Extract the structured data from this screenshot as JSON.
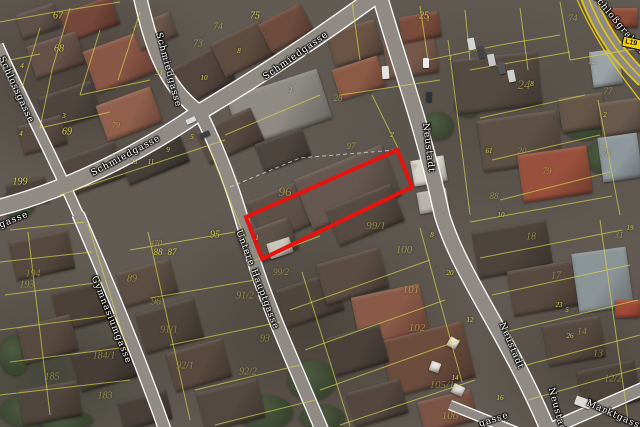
{
  "map": {
    "selected_parcel": {
      "outline_color": "#e8120e",
      "polygon": [
        [
          246,
          217
        ],
        [
          397,
          150
        ],
        [
          412,
          187
        ],
        [
          262,
          259
        ]
      ]
    },
    "route_badge": {
      "label": "L19",
      "bg_color": "#f2d10c"
    },
    "street_labels": [
      {
        "t": "Schmiedgasse",
        "x": 168,
        "y": 70,
        "r": 75
      },
      {
        "t": "Schmiedgasse",
        "x": 296,
        "y": 56,
        "r": -35
      },
      {
        "t": "Schmiedgasse",
        "x": 126,
        "y": 156,
        "r": -28
      },
      {
        "t": "Schlossgasse",
        "x": 16,
        "y": 90,
        "r": 65
      },
      {
        "t": "Gymnasiumgasse",
        "x": 111,
        "y": 320,
        "r": 68
      },
      {
        "t": "Untere Hauptgasse",
        "x": 257,
        "y": 280,
        "r": 69
      },
      {
        "t": "Neustadt",
        "x": 428,
        "y": 148,
        "r": 83
      },
      {
        "t": "Neustadt",
        "x": 511,
        "y": 346,
        "r": 67
      },
      {
        "t": "Neustadt",
        "x": 557,
        "y": 412,
        "r": 75
      },
      {
        "t": "Marktgasse",
        "x": 616,
        "y": 416,
        "r": 24
      },
      {
        "t": "Schloßgraben",
        "x": 618,
        "y": 24,
        "r": 50
      },
      {
        "t": "gasse",
        "x": 14,
        "y": 220,
        "r": -22
      },
      {
        "t": "gasse",
        "x": 494,
        "y": 420,
        "r": -18
      }
    ],
    "parcel_numbers": [
      [
        "67",
        58,
        16,
        10,
        0
      ],
      [
        "68",
        59,
        49,
        10,
        0
      ],
      [
        "69",
        67,
        132,
        10,
        0
      ],
      [
        "199",
        20,
        182,
        10,
        0
      ],
      [
        "79",
        116,
        125,
        8,
        1
      ],
      [
        "74",
        218,
        27,
        10,
        1
      ],
      [
        "73",
        198,
        44,
        10,
        1
      ],
      [
        "75",
        255,
        16,
        10,
        0
      ],
      [
        "96",
        285,
        192,
        13,
        1
      ],
      [
        "97",
        351,
        146,
        9,
        1
      ],
      [
        "25",
        424,
        16,
        10,
        0
      ],
      [
        "24",
        524,
        85,
        13,
        1
      ],
      [
        "74",
        573,
        18,
        9,
        1
      ],
      [
        "28",
        338,
        98,
        9,
        1
      ],
      [
        "12",
        592,
        61,
        9,
        1
      ],
      [
        "77",
        608,
        91,
        9,
        1
      ],
      [
        "78",
        606,
        153,
        9,
        1
      ],
      [
        "79",
        547,
        171,
        9,
        1
      ],
      [
        "20",
        522,
        151,
        9,
        1
      ],
      [
        "88",
        494,
        196,
        9,
        1
      ],
      [
        "31",
        619,
        235,
        9,
        1
      ],
      [
        "19",
        630,
        228,
        7,
        0
      ],
      [
        "18",
        531,
        237,
        10,
        1
      ],
      [
        "17",
        556,
        276,
        10,
        1
      ],
      [
        "14",
        582,
        332,
        10,
        1
      ],
      [
        "13",
        598,
        354,
        10,
        1
      ],
      [
        "12/2",
        613,
        379,
        10,
        1
      ],
      [
        "99/1",
        376,
        226,
        11,
        1
      ],
      [
        "99/2",
        281,
        272,
        9,
        1
      ],
      [
        "100",
        404,
        250,
        11,
        1
      ],
      [
        "101",
        411,
        290,
        11,
        1
      ],
      [
        "102",
        417,
        328,
        11,
        1
      ],
      [
        "105/1",
        442,
        385,
        11,
        1
      ],
      [
        "106",
        450,
        416,
        11,
        1
      ],
      [
        "95",
        215,
        235,
        10,
        0
      ],
      [
        "470",
        156,
        243,
        8,
        1
      ],
      [
        "88",
        158,
        252,
        9,
        0
      ],
      [
        "87",
        172,
        252,
        9,
        0
      ],
      [
        "89",
        132,
        279,
        10,
        1
      ],
      [
        "96",
        156,
        302,
        10,
        1
      ],
      [
        "91/1",
        169,
        330,
        10,
        1
      ],
      [
        "91/2",
        245,
        296,
        10,
        1
      ],
      [
        "92/1",
        185,
        366,
        10,
        1
      ],
      [
        "92/2",
        248,
        372,
        10,
        1
      ],
      [
        "93",
        265,
        339,
        10,
        1
      ],
      [
        "194",
        33,
        274,
        10,
        1
      ],
      [
        "193",
        27,
        285,
        10,
        1
      ],
      [
        "184/1",
        104,
        356,
        10,
        1
      ],
      [
        "185",
        52,
        377,
        10,
        1
      ],
      [
        "183",
        105,
        396,
        10,
        1
      ]
    ],
    "house_numbers": [
      [
        "4",
        22,
        66
      ],
      [
        "3",
        64,
        116
      ],
      [
        "4",
        21,
        134
      ],
      [
        "8",
        239,
        51
      ],
      [
        "10",
        204,
        78
      ],
      [
        "1",
        291,
        90
      ],
      [
        "33",
        159,
        73
      ],
      [
        "23",
        134,
        162
      ],
      [
        "11",
        151,
        162
      ],
      [
        "9",
        168,
        150
      ],
      [
        "5",
        192,
        137
      ],
      [
        "3",
        450,
        58
      ],
      [
        "1",
        428,
        19
      ],
      [
        "8",
        532,
        84
      ],
      [
        "2",
        605,
        115
      ],
      [
        "2",
        392,
        135
      ],
      [
        "7",
        414,
        168
      ],
      [
        "1",
        257,
        238
      ],
      [
        "61",
        489,
        151
      ],
      [
        "10",
        501,
        215
      ],
      [
        "8",
        432,
        235
      ],
      [
        "20",
        450,
        273
      ],
      [
        "12",
        470,
        320
      ],
      [
        "14",
        455,
        378
      ],
      [
        "16",
        500,
        398
      ],
      [
        "23",
        559,
        305
      ],
      [
        "26",
        570,
        336
      ],
      [
        "5",
        567,
        310
      ]
    ]
  }
}
